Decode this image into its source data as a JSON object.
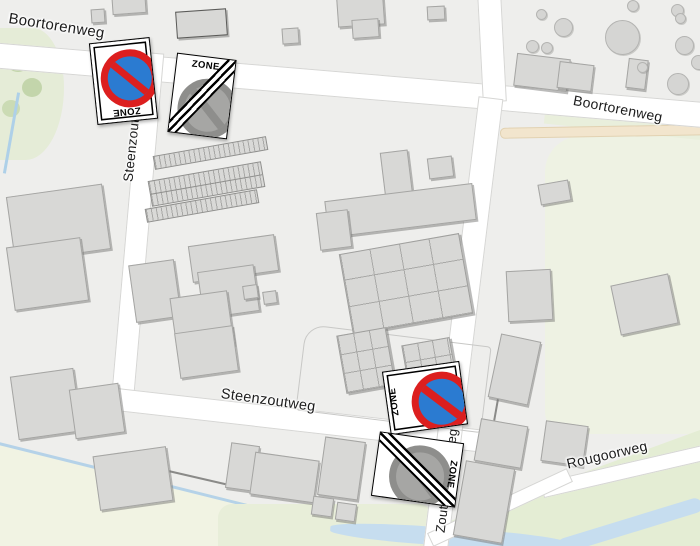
{
  "map": {
    "streets": {
      "boortorenweg_left": "Boortorenweg",
      "boortorenweg_right": "Boortorenweg",
      "steenzoutweg_vertical": "Steenzoutweg",
      "steenzoutweg_horizontal": "Steenzoutweg",
      "zoutwinningsweg": "Zoutwinningsweg",
      "rougoorweg": "Rougoorweg"
    },
    "signs": {
      "zone_start_top": {
        "label": "ZONE",
        "type": "no-parking-zone-start"
      },
      "zone_end_top": {
        "label": "ZONE",
        "type": "no-parking-zone-end"
      },
      "zone_start_bottom": {
        "label": "ZONE",
        "type": "no-parking-zone-start"
      },
      "zone_end_bottom": {
        "label": "ZONE",
        "type": "no-parking-zone-end"
      }
    },
    "colors": {
      "no_parking_blue": "#2b7bd1",
      "no_parking_red": "#dc1f1f",
      "zone_end_gray": "#8e8e8c",
      "map_background": "#eeeeec",
      "road_fill": "#ffffff",
      "building_fill": "#d8d8d6",
      "green_area": "#e7eed9",
      "water": "#c9dff0"
    }
  }
}
